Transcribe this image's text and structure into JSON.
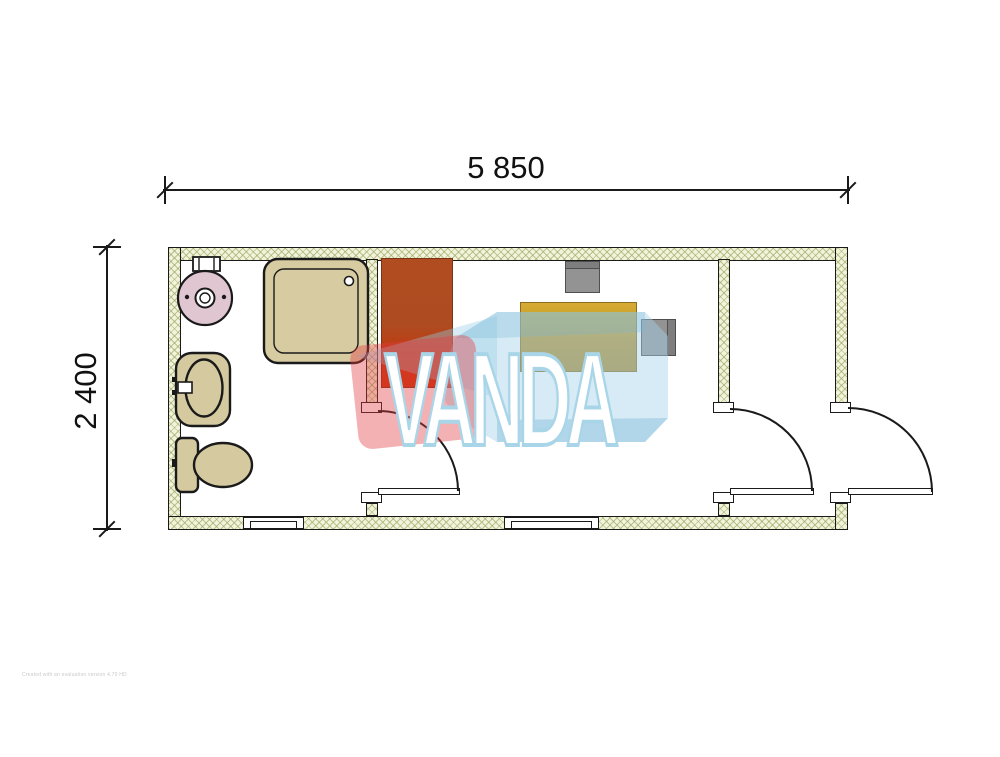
{
  "dimensions": {
    "width_label": "5 850",
    "height_label": "2 400"
  },
  "watermark": {
    "text": "VANDA",
    "blue": "rgba(163,211,233,0.45)",
    "blue_dark": "rgba(120,182,212,0.38)",
    "red": "rgba(228,60,66,0.40)",
    "text_color": "#ffffff",
    "text_outline": "#a9d5e8"
  },
  "fine_print": "Created with an evaluation version 4.70 HD",
  "colors": {
    "wall_hatch_bg": "#f3f3dc",
    "wall_hatch_line": "#9aa862",
    "wall_outline": "#1a1a1a",
    "fixture_beige": "#d5c99f",
    "washer_pink": "#dfc6d0",
    "wardrobe_top": "#b04c20",
    "wardrobe_bottom": "#cd3206",
    "desk_gold": "#c79f2e",
    "chair_gray": "#939393"
  },
  "fixtures": {
    "washer": "washing-machine",
    "shower": "shower-tray",
    "sink": "wash-basin",
    "toilet": "toilet",
    "wardrobe": "wardrobe",
    "desk": "desk",
    "chair1": "office-chair",
    "chair2": "office-chair",
    "doors": 3,
    "windows": 2
  }
}
